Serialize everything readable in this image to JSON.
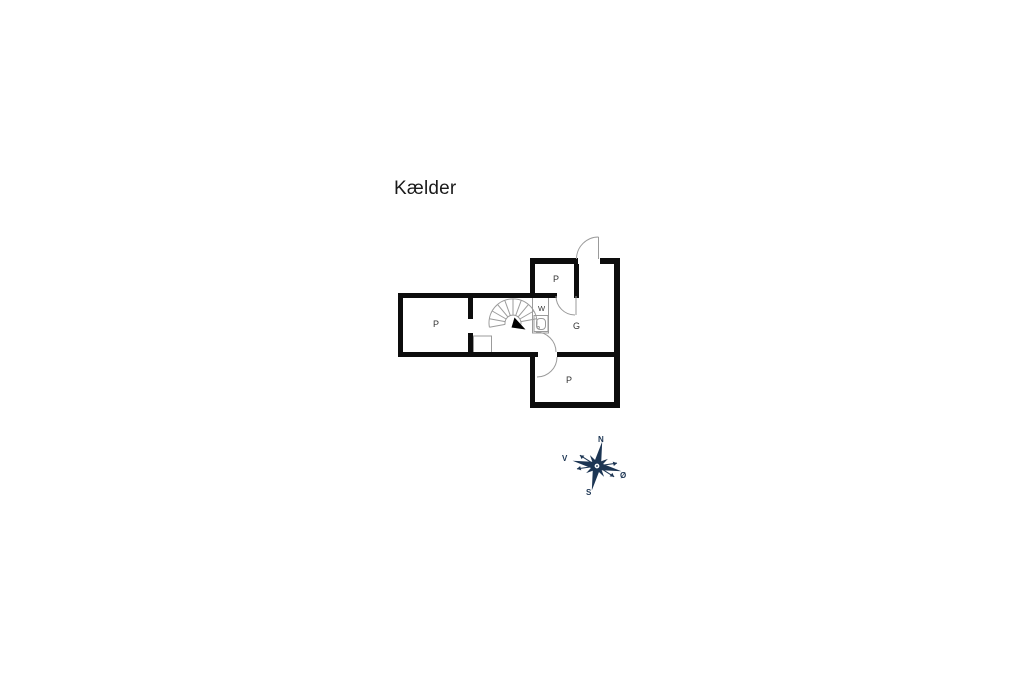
{
  "title": {
    "text": "Kælder"
  },
  "plan": {
    "rooms": [
      {
        "id": "room-p-left",
        "label": "P"
      },
      {
        "id": "room-p-top",
        "label": "P"
      },
      {
        "id": "room-g",
        "label": "G"
      },
      {
        "id": "room-w",
        "label": "W"
      },
      {
        "id": "room-p-bottom",
        "label": "P"
      }
    ],
    "features": [
      "spiral-staircase",
      "stair-direction-arrow",
      "wc-fixture",
      "entry-door-arc",
      "room-p-top-door-arc",
      "hall-to-g-door-arc",
      "g-to-p-bottom-door-arc",
      "closet-outline"
    ]
  },
  "compass": {
    "north": "N",
    "east": "Ø",
    "south": "S",
    "west": "V"
  },
  "colors": {
    "background": "#ffffff",
    "wall": "#0d0d0d",
    "thin_line": "#9b9b9b",
    "label": "#333333",
    "title": "#1a1a1a",
    "compass": "#1c3553"
  }
}
